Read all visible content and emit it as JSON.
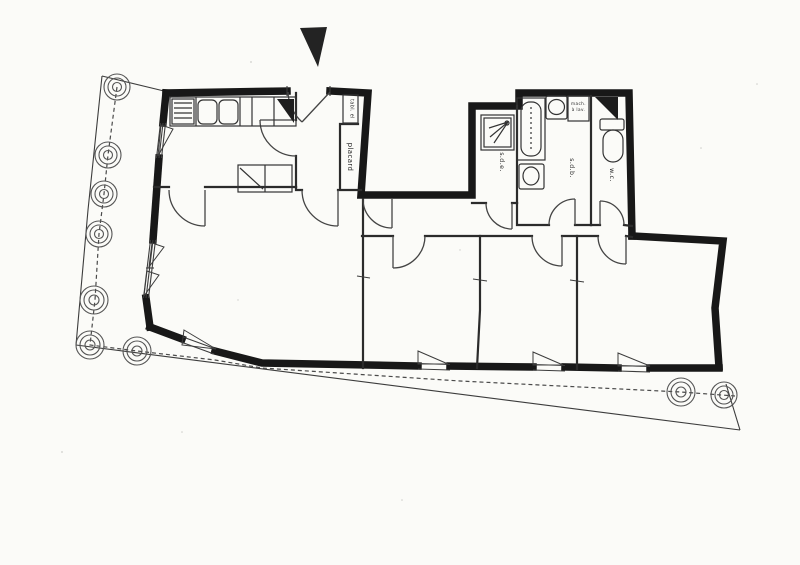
{
  "plan": {
    "labels": {
      "closet": "placard",
      "electrical_panel": "tabl. el",
      "shower_room": "s.d.e.",
      "bathroom": "s.d.b.",
      "wc": "w.c.",
      "washing_machine_line1": "mach.",
      "washing_machine_line2": "à lav."
    },
    "colors": {
      "ink": "#1c1c1c",
      "wall": "#181818",
      "paper": "#fbfbf8"
    }
  }
}
